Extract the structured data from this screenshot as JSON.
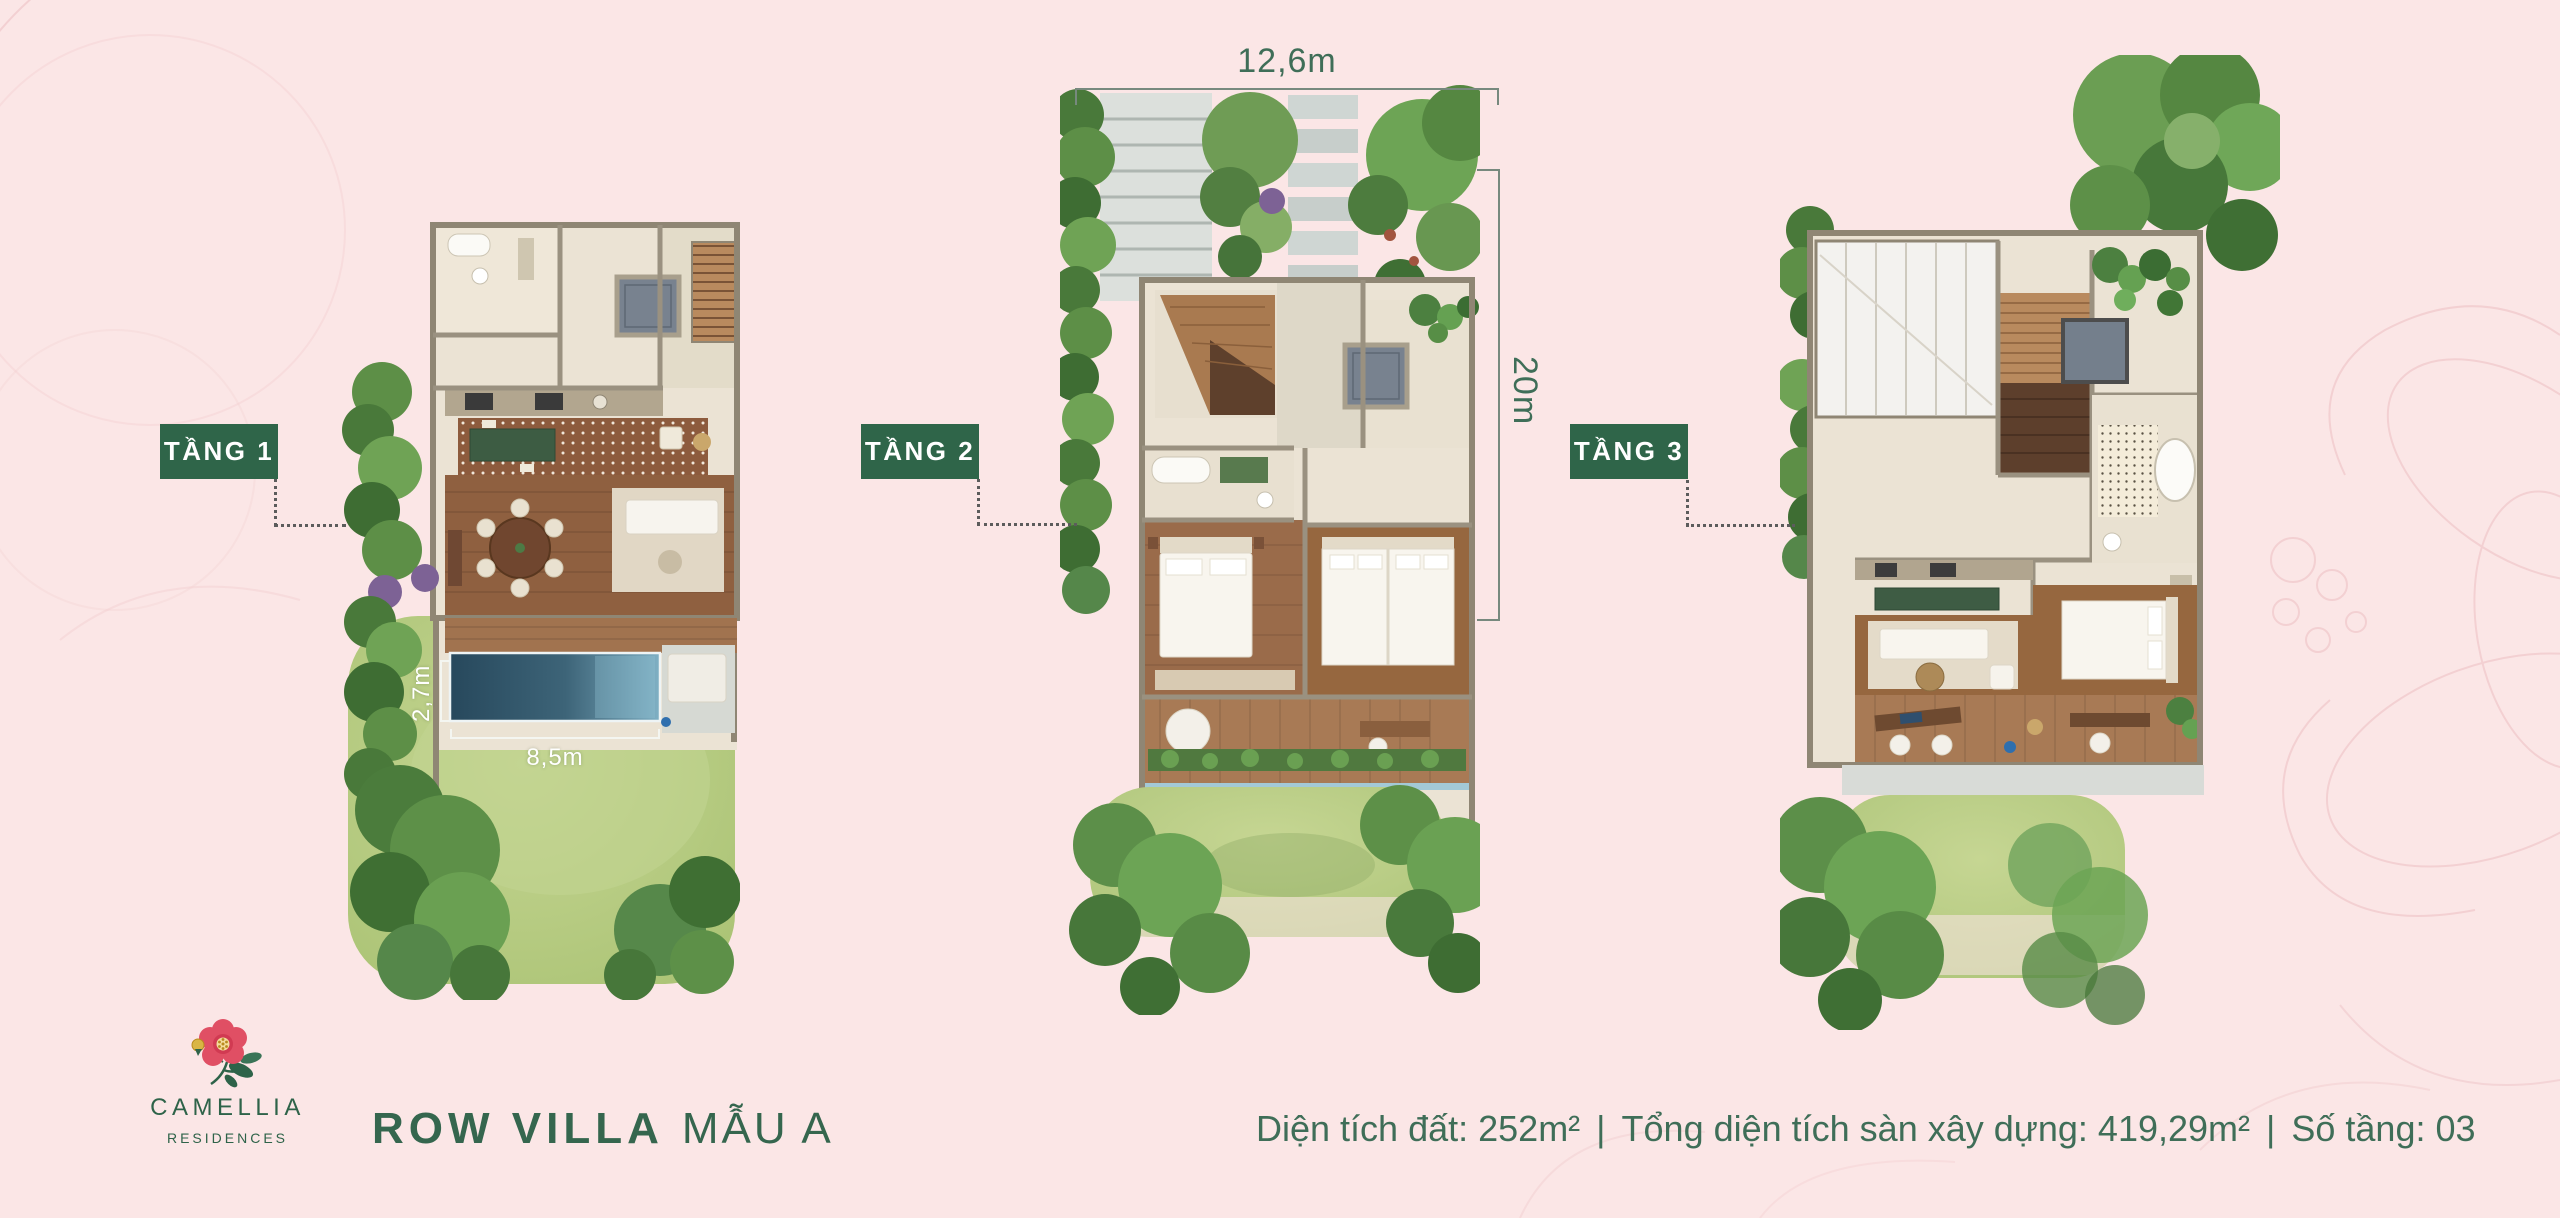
{
  "floor_labels": [
    {
      "label": "TẦNG 1"
    },
    {
      "label": "TẦNG 2"
    },
    {
      "label": "TẦNG 3"
    }
  ],
  "dimensions": {
    "lot_width": "12,6m",
    "lot_depth": "20m",
    "pool_length": "8,5m",
    "pool_width": "2,7m"
  },
  "logo": {
    "name": "CAMELLIA",
    "subtitle": "RESIDENCES"
  },
  "title": {
    "primary": "ROW VILLA",
    "secondary": "MẪU A"
  },
  "specs": {
    "land_area_label": "Diện tích đất:",
    "land_area_value": "252m²",
    "built_area_label": "Tổng diện tích sàn xây dựng:",
    "built_area_value": "419,29m²",
    "floors_label": "Số tầng:",
    "floors_value": "03",
    "separator": "|"
  },
  "colors": {
    "background": "#fbe6e6",
    "label_background": "#2f6549",
    "accent_green": "#3f6e58",
    "flower_pink": "#e04f64"
  }
}
